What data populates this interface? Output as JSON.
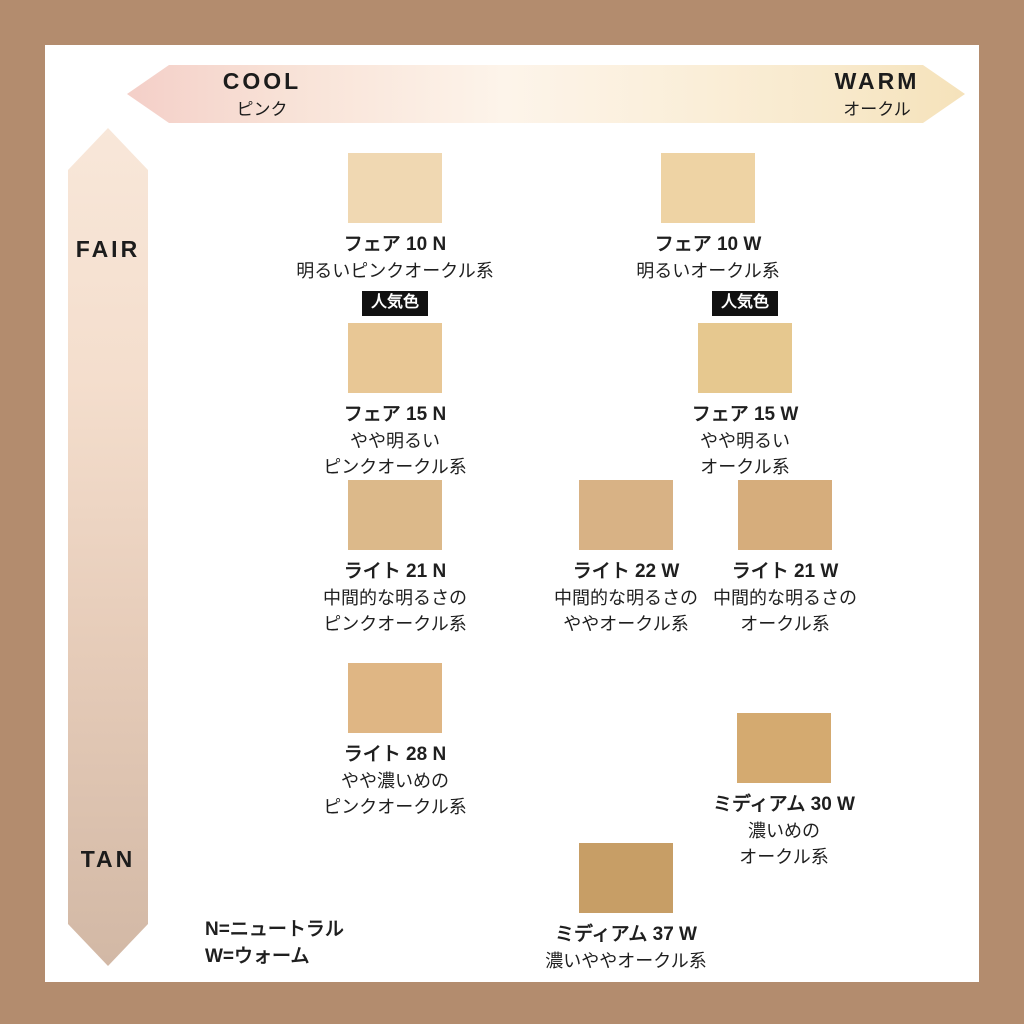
{
  "page": {
    "background": "#ffffff",
    "border_color": "#b38c6e"
  },
  "axes": {
    "horizontal": {
      "left_label": "COOL",
      "left_sublabel": "ピンク",
      "right_label": "WARM",
      "right_sublabel": "オークル",
      "gradient_start": "#f4cfc8",
      "gradient_end": "#f5e2ba"
    },
    "vertical": {
      "top_label": "FAIR",
      "bottom_label": "TAN",
      "gradient_start": "#f8e7d9",
      "gradient_end": "#d2b8a5"
    }
  },
  "badge_label": "人気色",
  "shades": [
    {
      "id": "fair-10-n",
      "name": "フェア 10 N",
      "desc": [
        "明るいピンクオークル系"
      ],
      "color": "#f0d8b2",
      "popular": false
    },
    {
      "id": "fair-10-w",
      "name": "フェア 10 W",
      "desc": [
        "明るいオークル系"
      ],
      "color": "#eed3a4",
      "popular": false
    },
    {
      "id": "fair-15-n",
      "name": "フェア 15 N",
      "desc": [
        "やや明るい",
        "ピンクオークル系"
      ],
      "color": "#e8c795",
      "popular": true
    },
    {
      "id": "fair-15-w",
      "name": "フェア 15 W",
      "desc": [
        "やや明るい",
        "オークル系"
      ],
      "color": "#e6c88f",
      "popular": true
    },
    {
      "id": "light-21-n",
      "name": "ライト 21 N",
      "desc": [
        "中間的な明るさの",
        "ピンクオークル系"
      ],
      "color": "#dcb98a",
      "popular": false
    },
    {
      "id": "light-22-w",
      "name": "ライト 22 W",
      "desc": [
        "中間的な明るさの",
        "ややオークル系"
      ],
      "color": "#d8b285",
      "popular": false
    },
    {
      "id": "light-21-w",
      "name": "ライト 21 W",
      "desc": [
        "中間的な明るさの",
        "オークル系"
      ],
      "color": "#d6ad7c",
      "popular": false
    },
    {
      "id": "light-28-n",
      "name": "ライト 28 N",
      "desc": [
        "やや濃いめの",
        "ピンクオークル系"
      ],
      "color": "#dfb684",
      "popular": false
    },
    {
      "id": "medium-30-w",
      "name": "ミディアム 30 W",
      "desc": [
        "濃いめの",
        "オークル系"
      ],
      "color": "#d4aa70",
      "popular": false
    },
    {
      "id": "medium-37-w",
      "name": "ミディアム 37 W",
      "desc": [
        "濃いややオークル系"
      ],
      "color": "#c79e66",
      "popular": false
    }
  ],
  "legend": {
    "line1": "N=ニュートラル",
    "line2": "W=ウォーム"
  }
}
